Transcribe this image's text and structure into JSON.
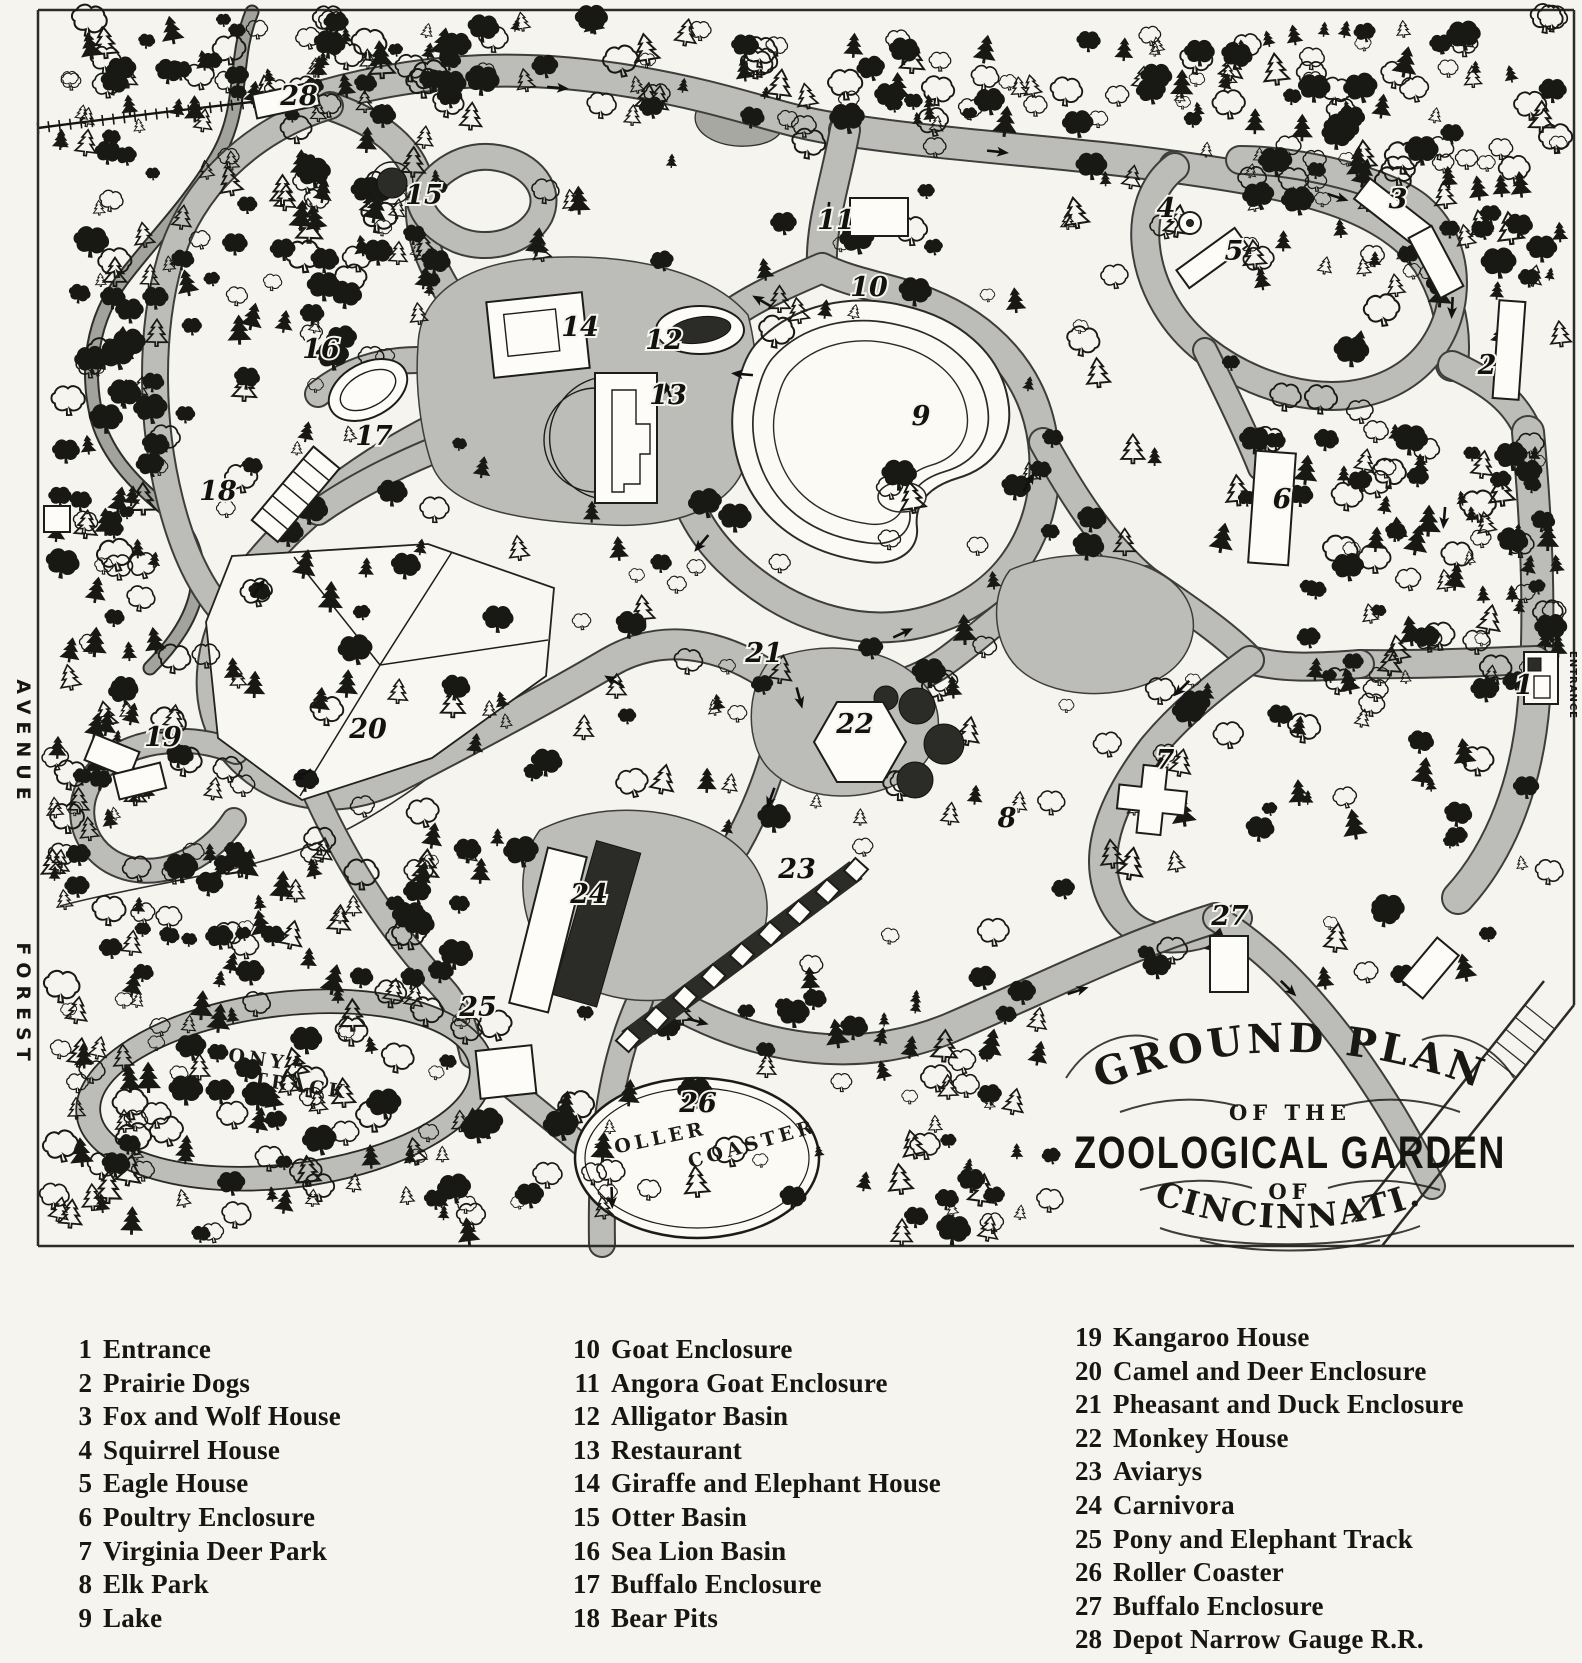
{
  "cartouche": {
    "line1": "GROUND PLAN",
    "line2": "OF THE",
    "line3": "ZOOLOGICAL GARDEN",
    "line4": "OF",
    "line5": "CINCINNATI."
  },
  "map": {
    "street": {
      "upper": "AVENUE",
      "lower": "FOREST"
    },
    "entrance_label": "ENTRANCE",
    "pony_track": [
      "PONY",
      "TRACK"
    ],
    "roller_coaster": [
      "ROLLER",
      "COASTER"
    ],
    "markers": [
      {
        "num": "1",
        "name": "Entrance",
        "x": 1524,
        "y": 694
      },
      {
        "num": "2",
        "name": "Prairie Dogs",
        "x": 1487,
        "y": 374
      },
      {
        "num": "3",
        "name": "Fox and Wolf House",
        "x": 1398,
        "y": 208
      },
      {
        "num": "4",
        "name": "Squirrel House",
        "x": 1166,
        "y": 217
      },
      {
        "num": "5",
        "name": "Eagle House",
        "x": 1234,
        "y": 260
      },
      {
        "num": "6",
        "name": "Poultry Enclosure",
        "x": 1282,
        "y": 508
      },
      {
        "num": "7",
        "name": "Virginia Deer Park",
        "x": 1165,
        "y": 769
      },
      {
        "num": "8",
        "name": "Elk Park",
        "x": 1007,
        "y": 827
      },
      {
        "num": "9",
        "name": "Lake",
        "x": 921,
        "y": 425
      },
      {
        "num": "10",
        "name": "Goat Enclosure",
        "x": 869,
        "y": 296
      },
      {
        "num": "11",
        "name": "Angora Goat Enclosure",
        "x": 836,
        "y": 229
      },
      {
        "num": "12",
        "name": "Alligator Basin",
        "x": 664,
        "y": 349
      },
      {
        "num": "13",
        "name": "Restaurant",
        "x": 668,
        "y": 404
      },
      {
        "num": "14",
        "name": "Giraffe and Elephant House",
        "x": 580,
        "y": 336
      },
      {
        "num": "15",
        "name": "Otter Basin",
        "x": 424,
        "y": 204
      },
      {
        "num": "16",
        "name": "Sea Lion Basin",
        "x": 321,
        "y": 358
      },
      {
        "num": "17",
        "name": "Buffalo Enclosure",
        "x": 374,
        "y": 445
      },
      {
        "num": "18",
        "name": "Bear Pits",
        "x": 218,
        "y": 500
      },
      {
        "num": "19",
        "name": "Kangaroo House",
        "x": 163,
        "y": 746
      },
      {
        "num": "20",
        "name": "Camel and Deer Enclosure",
        "x": 368,
        "y": 738
      },
      {
        "num": "21",
        "name": "Pheasant and Duck Enclosure",
        "x": 764,
        "y": 662
      },
      {
        "num": "22",
        "name": "Monkey House",
        "x": 855,
        "y": 733
      },
      {
        "num": "23",
        "name": "Aviarys",
        "x": 797,
        "y": 878
      },
      {
        "num": "24",
        "name": "Carnivora",
        "x": 589,
        "y": 903
      },
      {
        "num": "25",
        "name": "Pony and Elephant Track",
        "x": 478,
        "y": 1016
      },
      {
        "num": "26",
        "name": "Roller Coaster",
        "x": 698,
        "y": 1112
      },
      {
        "num": "27",
        "name": "Buffalo Enclosure",
        "x": 1230,
        "y": 925
      },
      {
        "num": "28",
        "name": "Depot Narrow Gauge R.R.",
        "x": 299,
        "y": 105
      }
    ]
  },
  "legend": {
    "columns": [
      {
        "items": [
          {
            "num": "1",
            "label": "Entrance"
          },
          {
            "num": "2",
            "label": "Prairie Dogs"
          },
          {
            "num": "3",
            "label": "Fox and Wolf House"
          },
          {
            "num": "4",
            "label": "Squirrel House"
          },
          {
            "num": "5",
            "label": "Eagle House"
          },
          {
            "num": "6",
            "label": "Poultry Enclosure"
          },
          {
            "num": "7",
            "label": "Virginia Deer Park"
          },
          {
            "num": "8",
            "label": "Elk Park"
          },
          {
            "num": "9",
            "label": "Lake"
          }
        ]
      },
      {
        "items": [
          {
            "num": "10",
            "label": "Goat Enclosure"
          },
          {
            "num": "11",
            "label": "Angora Goat Enclosure"
          },
          {
            "num": "12",
            "label": "Alligator Basin"
          },
          {
            "num": "13",
            "label": "Restaurant"
          },
          {
            "num": "14",
            "label": "Giraffe and Elephant House"
          },
          {
            "num": "15",
            "label": "Otter Basin"
          },
          {
            "num": "16",
            "label": "Sea Lion Basin"
          },
          {
            "num": "17",
            "label": "Buffalo Enclosure"
          },
          {
            "num": "18",
            "label": "Bear Pits"
          }
        ]
      },
      {
        "items": [
          {
            "num": "19",
            "label": "Kangaroo House"
          },
          {
            "num": "20",
            "label": "Camel and Deer Enclosure"
          },
          {
            "num": "21",
            "label": "Pheasant and Duck Enclosure"
          },
          {
            "num": "22",
            "label": "Monkey House"
          },
          {
            "num": "23",
            "label": "Aviarys"
          },
          {
            "num": "24",
            "label": "Carnivora"
          },
          {
            "num": "25",
            "label": "Pony and Elephant Track"
          },
          {
            "num": "26",
            "label": "Roller Coaster"
          },
          {
            "num": "27",
            "label": "Buffalo Enclosure"
          },
          {
            "num": "28",
            "label": "Depot Narrow Gauge R.R."
          }
        ]
      }
    ]
  },
  "colors": {
    "paper": "#f6f4ee",
    "ink": "#181815",
    "walk": "#bcbcb8"
  }
}
